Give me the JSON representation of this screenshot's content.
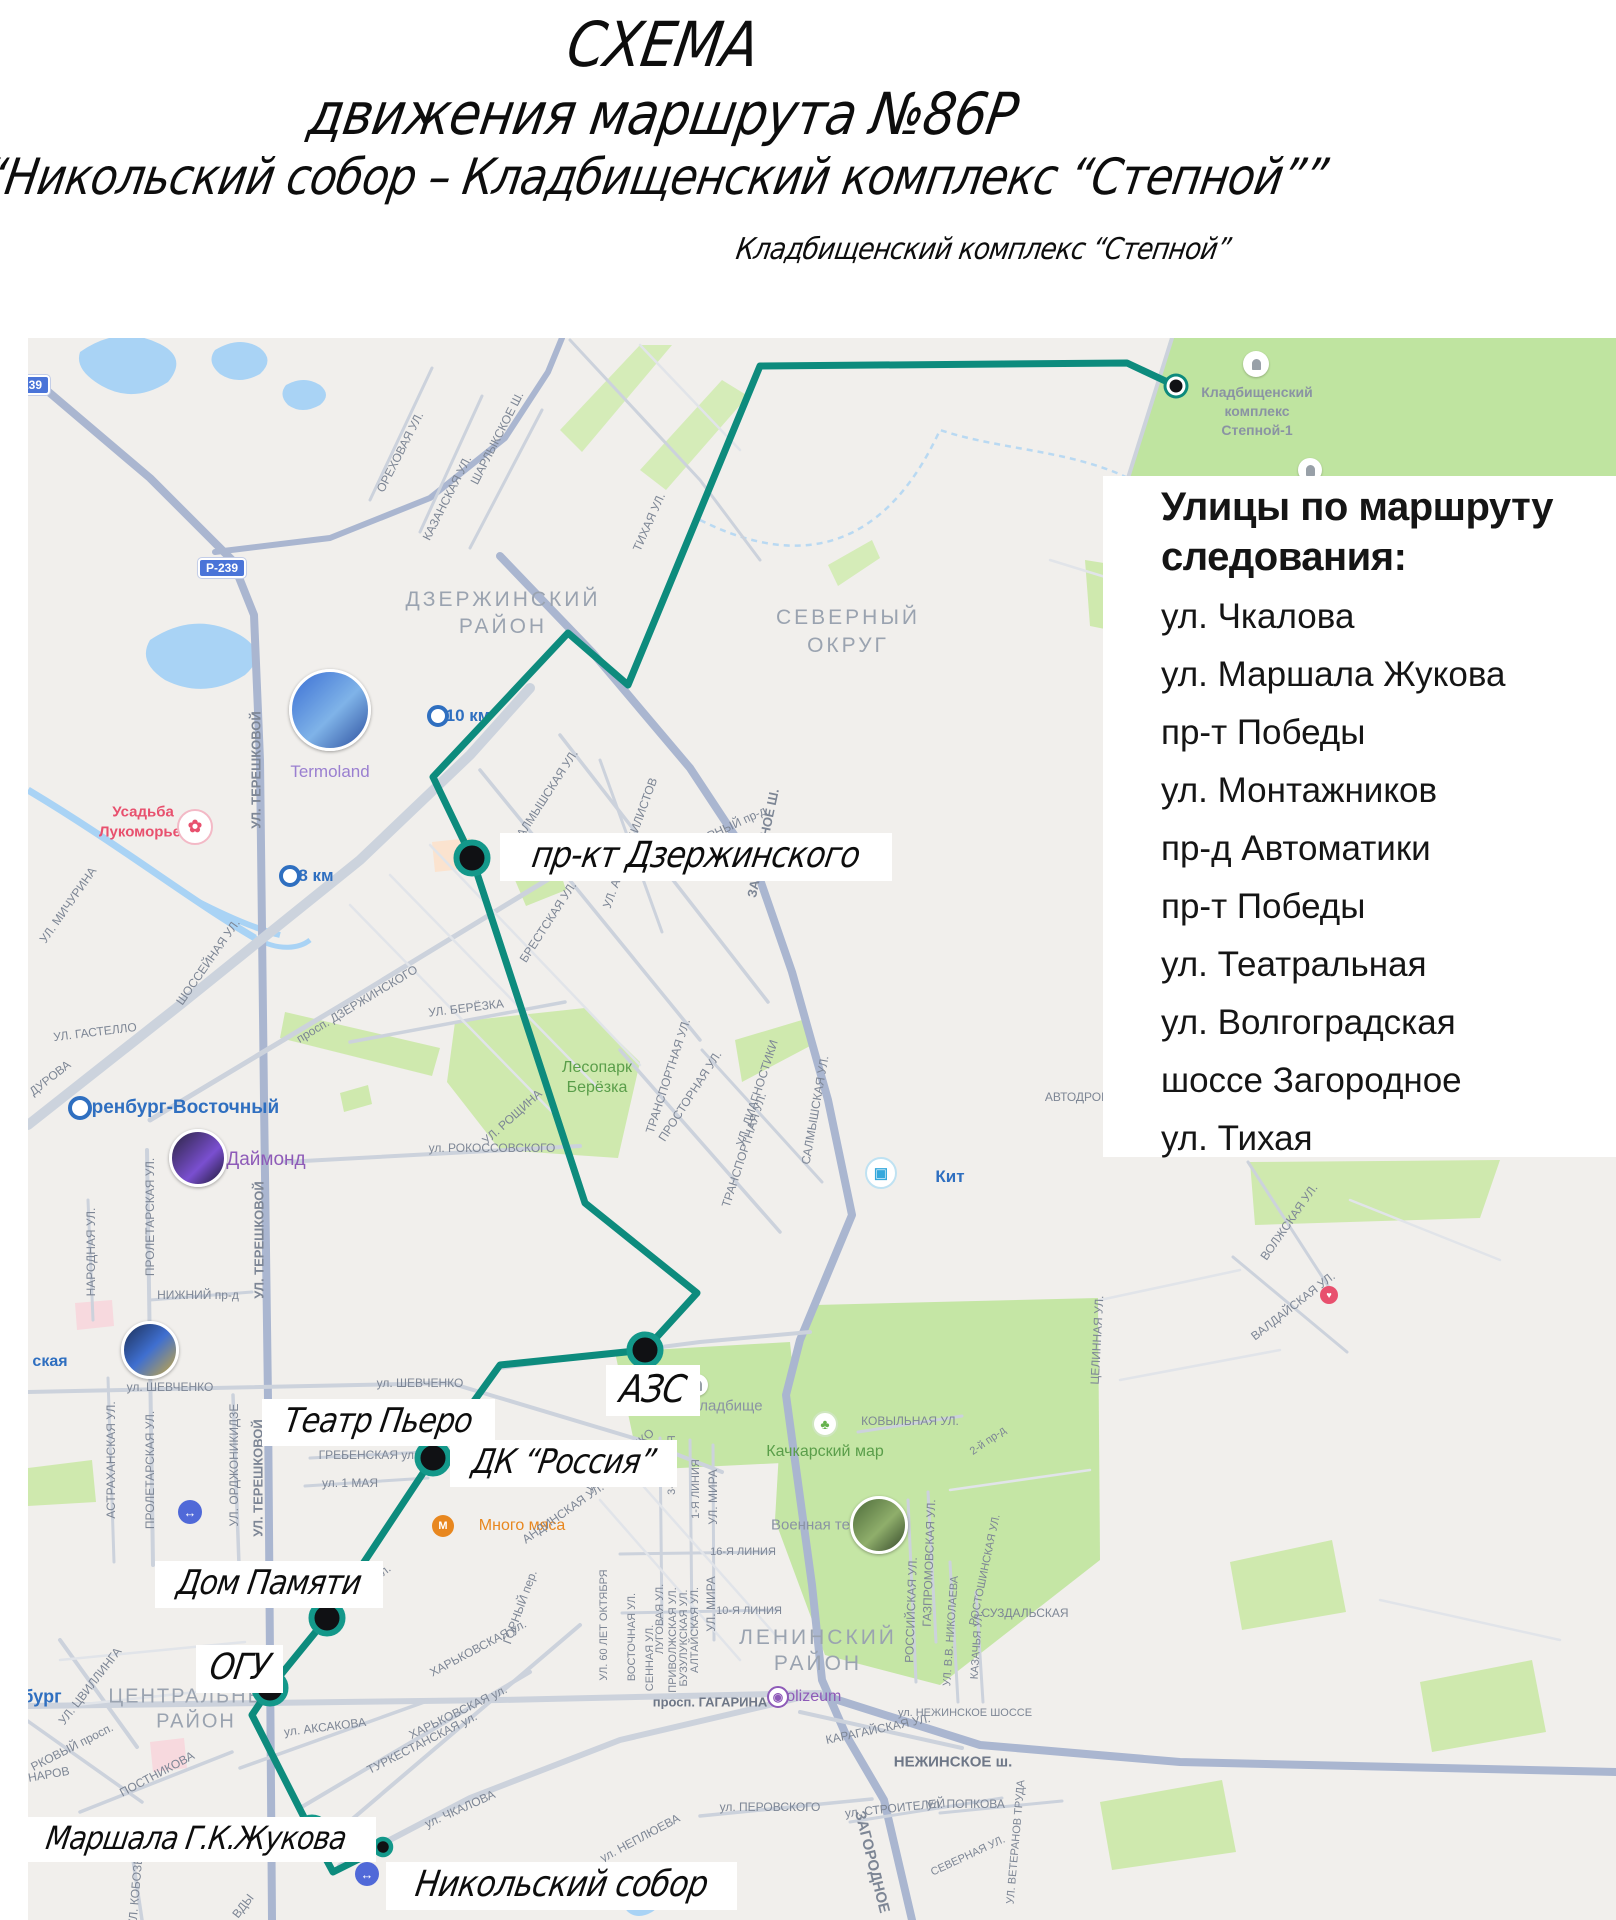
{
  "title": {
    "line1": "СХЕМА",
    "line2": "движения маршрута №86Р",
    "line3": "“Никольский собор – Кладбищенский комплекс “Степной””"
  },
  "endpoint_caption": "Кладбищенский комплекс “Степной”",
  "streets_panel": {
    "heading_line1": "Улицы по маршруту",
    "heading_line2": "следования:",
    "items": [
      "ул. Чкалова",
      "ул. Маршала Жукова",
      "пр-т Победы",
      "ул. Монтажников",
      "пр-д Автоматики",
      "пр-т Победы",
      "ул. Театральная",
      "ул. Волгоградская",
      "шоссе Загородное",
      "ул. Тихая"
    ]
  },
  "route": {
    "color": "#0d8b7d",
    "points": [
      [
        1176,
        386
      ],
      [
        1127,
        363
      ],
      [
        760,
        366
      ],
      [
        628,
        685
      ],
      [
        568,
        633
      ],
      [
        433,
        777
      ],
      [
        472,
        858
      ],
      [
        585,
        1203
      ],
      [
        697,
        1293
      ],
      [
        645,
        1350
      ],
      [
        500,
        1365
      ],
      [
        433,
        1458
      ],
      [
        327,
        1618
      ],
      [
        270,
        1688
      ],
      [
        252,
        1715
      ],
      [
        312,
        1833
      ],
      [
        333,
        1872
      ],
      [
        383,
        1847
      ]
    ]
  },
  "stops": [
    {
      "name": "stop-kladbishchensky-kompleks",
      "x": 1176,
      "y": 386,
      "type": "terminal"
    },
    {
      "name": "stop-prkt-dzerzhinskogo",
      "x": 472,
      "y": 858,
      "type": "big"
    },
    {
      "name": "stop-azs",
      "x": 645,
      "y": 1350,
      "type": "big"
    },
    {
      "name": "stop-dk-rossiya",
      "x": 433,
      "y": 1458,
      "type": "big"
    },
    {
      "name": "stop-dom-pamyati",
      "x": 327,
      "y": 1618,
      "type": "big"
    },
    {
      "name": "stop-ogu",
      "x": 270,
      "y": 1688,
      "type": "big"
    },
    {
      "name": "stop-marshala-zhukova",
      "x": 312,
      "y": 1833,
      "type": "big"
    },
    {
      "name": "stop-nikolsky-sobor",
      "x": 383,
      "y": 1847,
      "type": "small"
    }
  ],
  "hand_labels": [
    {
      "name": "stop-label-prkt-dzerzhinskogo",
      "text": "пр-кт Дзержинского",
      "x": 500,
      "y": 833,
      "fs": 36
    },
    {
      "name": "stop-label-azs",
      "text": "АЗС",
      "x": 606,
      "y": 1365,
      "fs": 38
    },
    {
      "name": "stop-label-teatr-piero",
      "text": "Театр Пьеро",
      "x": 262,
      "y": 1399,
      "fs": 34
    },
    {
      "name": "stop-label-dk-rossiya",
      "text": "ДК “Россия”",
      "x": 450,
      "y": 1440,
      "fs": 34
    },
    {
      "name": "stop-label-dom-pamyati",
      "text": "Дом Памяти",
      "x": 155,
      "y": 1561,
      "fs": 34
    },
    {
      "name": "stop-label-ogu",
      "text": "ОГУ",
      "x": 196,
      "y": 1645,
      "fs": 36
    },
    {
      "name": "stop-label-marshala-zhukova",
      "text": "Маршала Г.К.Жукова",
      "x": 16,
      "y": 1817,
      "fs": 32
    },
    {
      "name": "stop-label-nikolsky-sobor",
      "text": "Никольский собор",
      "x": 386,
      "y": 1862,
      "fs": 36
    }
  ],
  "cemetery_poi_label": {
    "lines": [
      "Кладбищенский",
      "комплекс",
      "Степной-1"
    ],
    "x": 1257,
    "y": 392,
    "line_h": 19
  },
  "km_markers": [
    {
      "name": "km-10-label",
      "text": "10 км",
      "x": 468,
      "y": 716
    },
    {
      "name": "km-8-label",
      "text": "8 км",
      "x": 316,
      "y": 876
    }
  ],
  "road_badges": [
    {
      "name": "road-badge-r239",
      "text": "Р-239",
      "x": 222,
      "y": 568
    },
    {
      "name": "road-badge-r239-edge",
      "text": "Р-239",
      "x": 26,
      "y": 385
    }
  ],
  "map_labels": [
    {
      "t": "ОРЕХОВАЯ УЛ.",
      "x": 400,
      "y": 452,
      "r": -63,
      "s": 12
    },
    {
      "t": "КАЗАНСКАЯ УЛ.",
      "x": 447,
      "y": 498,
      "r": -63,
      "s": 12
    },
    {
      "t": "ШАРЛЫКСКОЕ Ш.",
      "x": 497,
      "y": 438,
      "r": -63,
      "s": 12
    },
    {
      "t": "УЛ. ТЕРЕШКОВОЙ",
      "x": 256,
      "y": 770,
      "r": -90,
      "s": 13,
      "b": 1
    },
    {
      "t": "ДЗЕРЖИНСКИЙ",
      "x": 503,
      "y": 600,
      "s": 21,
      "c": "district",
      "ls": 3
    },
    {
      "t": "РАЙОН",
      "x": 503,
      "y": 627,
      "s": 21,
      "c": "district",
      "ls": 3
    },
    {
      "t": "СЕВЕРНЫЙ",
      "x": 848,
      "y": 618,
      "s": 21,
      "c": "district",
      "ls": 3
    },
    {
      "t": "ОКРУГ",
      "x": 848,
      "y": 646,
      "s": 21,
      "c": "district",
      "ls": 3
    },
    {
      "t": "ТИХАЯ УЛ.",
      "x": 649,
      "y": 522,
      "r": -66,
      "s": 12
    },
    {
      "t": "ПРОСТОРНАЯ УЛ.",
      "x": 690,
      "y": 1096,
      "r": -57,
      "s": 12
    },
    {
      "t": "САЛМЫШСКАЯ УЛ.",
      "x": 545,
      "y": 797,
      "r": -57,
      "s": 12
    },
    {
      "t": "БРЕСТСКАЯ УЛ.",
      "x": 548,
      "y": 922,
      "r": -57,
      "s": 12
    },
    {
      "t": "УЛ. АВТОМОБИЛИСТОВ",
      "x": 630,
      "y": 843,
      "r": -70,
      "s": 12
    },
    {
      "t": "СЕВЕРНЫЙ пр-д",
      "x": 722,
      "y": 830,
      "r": -25,
      "s": 12
    },
    {
      "t": "ЗАГОРОДНОЕ Ш.",
      "x": 763,
      "y": 843,
      "r": -78,
      "s": 13,
      "b": 1
    },
    {
      "t": "Termoland",
      "x": 330,
      "y": 772,
      "s": 17,
      "c": "purpleL"
    },
    {
      "t": "Усадьба",
      "x": 143,
      "y": 812,
      "s": 15,
      "c": "pink",
      "b": 1
    },
    {
      "t": "Лукоморье",
      "x": 140,
      "y": 832,
      "s": 15,
      "c": "pink",
      "b": 1
    },
    {
      "t": "УЛ. МИЧУРИНА",
      "x": 68,
      "y": 905,
      "r": -55,
      "s": 12
    },
    {
      "t": "ШОССЕЙНАЯ УЛ.",
      "x": 208,
      "y": 962,
      "r": -55,
      "s": 12
    },
    {
      "t": "УЛ. ГАСТЕЛЛО",
      "x": 95,
      "y": 1032,
      "r": -7,
      "s": 12
    },
    {
      "t": "ДУРОВА",
      "x": 50,
      "y": 1078,
      "r": -38,
      "s": 12
    },
    {
      "t": "Оренбург-Восточный",
      "x": 178,
      "y": 1108,
      "s": 19,
      "c": "blue",
      "b": 1
    },
    {
      "t": "Даймонд",
      "x": 266,
      "y": 1160,
      "s": 19,
      "c": "purple"
    },
    {
      "t": "просп. ДЗЕРЖИНСКОГО",
      "x": 357,
      "y": 1004,
      "r": -31,
      "s": 12
    },
    {
      "t": "УЛ. БЕРЁЗКА",
      "x": 466,
      "y": 1008,
      "r": -7,
      "s": 12
    },
    {
      "t": "УЛ. РОЩИНА",
      "x": 512,
      "y": 1117,
      "r": -42,
      "s": 12
    },
    {
      "t": "ул. РОКОССОВСКОГО",
      "x": 492,
      "y": 1148,
      "s": 12
    },
    {
      "t": "Лесопарк",
      "x": 597,
      "y": 1068,
      "s": 16,
      "c": "green"
    },
    {
      "t": "Берёзка",
      "x": 597,
      "y": 1088,
      "s": 16,
      "c": "green"
    },
    {
      "t": "ТРАНСПОРТНАЯ УЛ.",
      "x": 668,
      "y": 1076,
      "r": -72,
      "s": 12
    },
    {
      "t": "ТРАНСПОРТНАЯ УЛ.",
      "x": 744,
      "y": 1150,
      "r": -72,
      "s": 12
    },
    {
      "t": "УЛ. ДИАГНОСТИКИ",
      "x": 757,
      "y": 1093,
      "r": -72,
      "s": 12
    },
    {
      "t": "САЛМЫШСКАЯ УЛ.",
      "x": 815,
      "y": 1110,
      "r": -80,
      "s": 12
    },
    {
      "t": "Кит",
      "x": 950,
      "y": 1177,
      "s": 17,
      "c": "blue",
      "b": 1
    },
    {
      "t": "АВТОДРОМ",
      "x": 1078,
      "y": 1097,
      "s": 12
    },
    {
      "t": "КОВЫЛЬНАЯ УЛ.",
      "x": 910,
      "y": 1421,
      "s": 12
    },
    {
      "t": "2-й пр-д",
      "x": 988,
      "y": 1441,
      "r": -35,
      "s": 11
    },
    {
      "t": "Качкарский мар",
      "x": 825,
      "y": 1452,
      "s": 16,
      "c": "green"
    },
    {
      "t": "Военная техника",
      "x": 830,
      "y": 1525,
      "s": 15,
      "c": "gray"
    },
    {
      "t": "Старое кладбище",
      "x": 700,
      "y": 1406,
      "s": 15,
      "c": "gray"
    },
    {
      "t": "ЦЕЛИННАЯ УЛ.",
      "x": 1097,
      "y": 1340,
      "r": -87,
      "s": 12
    },
    {
      "t": "ВОЛЖСКАЯ УЛ.",
      "x": 1289,
      "y": 1222,
      "r": -55,
      "s": 12
    },
    {
      "t": "ВАЛДАЙСКАЯ УЛ.",
      "x": 1293,
      "y": 1306,
      "r": -38,
      "s": 12
    },
    {
      "t": "ЛЕНИНСКИЙ",
      "x": 818,
      "y": 1638,
      "s": 21,
      "c": "district",
      "ls": 3
    },
    {
      "t": "РАЙОН",
      "x": 818,
      "y": 1664,
      "s": 21,
      "c": "district",
      "ls": 3
    },
    {
      "t": "РОССИЙСКАЯ УЛ.",
      "x": 911,
      "y": 1610,
      "r": -88,
      "s": 12
    },
    {
      "t": "ГАЗПРОМОВСКАЯ УЛ.",
      "x": 929,
      "y": 1563,
      "r": -88,
      "s": 12
    },
    {
      "t": "УЛ. В.В. НИКОЛАЕВА",
      "x": 951,
      "y": 1631,
      "r": -86,
      "s": 11
    },
    {
      "t": "КАЗАЧЬЯ УЛ.",
      "x": 977,
      "y": 1645,
      "r": -86,
      "s": 11
    },
    {
      "t": "РОСТОШИНСКАЯ УЛ.",
      "x": 985,
      "y": 1570,
      "r": -78,
      "s": 11
    },
    {
      "t": "СУЗДАЛЬСКАЯ",
      "x": 1025,
      "y": 1613,
      "s": 12
    },
    {
      "t": "УЛ. МИРА",
      "x": 713,
      "y": 1497,
      "r": -90,
      "s": 12
    },
    {
      "t": "УЛ. МИРА",
      "x": 711,
      "y": 1604,
      "r": -90,
      "s": 12
    },
    {
      "t": "3-Я ЛИНИЯ",
      "x": 672,
      "y": 1465,
      "r": -90,
      "s": 11
    },
    {
      "t": "1-Я ЛИНИЯ",
      "x": 696,
      "y": 1489,
      "r": -90,
      "s": 11
    },
    {
      "t": "16-Я ЛИНИЯ",
      "x": 743,
      "y": 1552,
      "s": 11
    },
    {
      "t": "10-Я ЛИНИЯ",
      "x": 749,
      "y": 1611,
      "s": 11
    },
    {
      "t": "УЛ. 60 ЛЕТ ОКТЯБРЯ",
      "x": 604,
      "y": 1625,
      "r": -90,
      "s": 11
    },
    {
      "t": "ВОСТОЧНАЯ УЛ.",
      "x": 632,
      "y": 1637,
      "r": -90,
      "s": 11
    },
    {
      "t": "СЕННАЯ УЛ.",
      "x": 650,
      "y": 1658,
      "r": -90,
      "s": 11
    },
    {
      "t": "ЛУГОВАЯ УЛ.",
      "x": 660,
      "y": 1619,
      "r": -90,
      "s": 11
    },
    {
      "t": "ПРИВОЛЖСКАЯ УЛ.",
      "x": 673,
      "y": 1640,
      "r": -90,
      "s": 11
    },
    {
      "t": "БУЗУЛУКСКАЯ УЛ.",
      "x": 684,
      "y": 1638,
      "r": -90,
      "s": 11
    },
    {
      "t": "АЛТАЙСКАЯ УЛ.",
      "x": 695,
      "y": 1630,
      "r": -90,
      "s": 11
    },
    {
      "t": "просп. ГАГАРИНА",
      "x": 710,
      "y": 1702,
      "s": 13,
      "b": 1,
      "c": "streetDark"
    },
    {
      "t": "Colizeum",
      "x": 808,
      "y": 1697,
      "s": 16,
      "c": "purple"
    },
    {
      "t": "КАРАГАЙСКАЯ УЛ.",
      "x": 878,
      "y": 1729,
      "r": -12,
      "s": 12
    },
    {
      "t": "ул. НЕЖИНСКОЕ ШОССЕ",
      "x": 965,
      "y": 1713,
      "s": 11
    },
    {
      "t": "НЕЖИНСКОЕ ш.",
      "x": 953,
      "y": 1762,
      "s": 15,
      "b": 1,
      "c": "streetDark"
    },
    {
      "t": "ул. ПЕРОВСКОГО",
      "x": 770,
      "y": 1807,
      "s": 12
    },
    {
      "t": "ул. СТРОИТЕЛЕЙ",
      "x": 895,
      "y": 1808,
      "r": -6,
      "s": 12
    },
    {
      "t": "ул. ПОПКОВА",
      "x": 966,
      "y": 1804,
      "s": 12
    },
    {
      "t": "ул. НЕПЛЮЕВА",
      "x": 640,
      "y": 1838,
      "r": -28,
      "s": 12
    },
    {
      "t": "ЗАГОРОДНОЕ",
      "x": 872,
      "y": 1862,
      "r": 76,
      "s": 15,
      "b": 1
    },
    {
      "t": "СЕВЕРНАЯ УЛ.",
      "x": 968,
      "y": 1856,
      "r": -25,
      "s": 11
    },
    {
      "t": "УЛ. ВЕТЕРАНОВ ТРУДА",
      "x": 1016,
      "y": 1842,
      "r": -85,
      "s": 11
    },
    {
      "t": "ул. ШЕВЧЕНКО",
      "x": 170,
      "y": 1387,
      "s": 12
    },
    {
      "t": "ул. ШЕВЧЕНКО",
      "x": 420,
      "y": 1383,
      "s": 12
    },
    {
      "t": "ул. ШЕВЧЕНКО",
      "x": 620,
      "y": 1460,
      "r": -42,
      "s": 12
    },
    {
      "t": "ГРЕБЕНСКАЯ ул.",
      "x": 368,
      "y": 1455,
      "s": 12
    },
    {
      "t": "ул. 1 МАЯ",
      "x": 350,
      "y": 1483,
      "s": 12
    },
    {
      "t": "Много мяса",
      "x": 522,
      "y": 1526,
      "s": 16,
      "c": "orange"
    },
    {
      "t": "ОРСКАЯ ул.",
      "x": 362,
      "y": 1588,
      "r": -38,
      "s": 12
    },
    {
      "t": "ГОРНЫЙ пер.",
      "x": 520,
      "y": 1607,
      "r": -70,
      "s": 12
    },
    {
      "t": "АНДИНСКАЯ УЛ.",
      "x": 563,
      "y": 1513,
      "r": -35,
      "s": 12
    },
    {
      "t": "ХАРЬКОВСКАЯ ул.",
      "x": 478,
      "y": 1648,
      "r": -28,
      "s": 12
    },
    {
      "t": "ХАРЬКОВСКАЯ ул.",
      "x": 458,
      "y": 1712,
      "r": -26,
      "s": 12
    },
    {
      "t": "ТУРКЕСТАНСКАЯ ул.",
      "x": 422,
      "y": 1743,
      "r": -27,
      "s": 12
    },
    {
      "t": "ул. АКСАКОВА",
      "x": 325,
      "y": 1727,
      "r": -7,
      "s": 12
    },
    {
      "t": "ул. ЧКАЛОВА",
      "x": 460,
      "y": 1809,
      "r": -24,
      "s": 12
    },
    {
      "t": "ЦЕНТРАЛЬНЫЙ",
      "x": 196,
      "y": 1697,
      "s": 20,
      "c": "district",
      "ls": 2
    },
    {
      "t": "РАЙОН",
      "x": 196,
      "y": 1722,
      "s": 20,
      "c": "district",
      "ls": 2
    },
    {
      "t": "бург",
      "x": 42,
      "y": 1697,
      "s": 18,
      "c": "blue",
      "b": 1
    },
    {
      "t": "УЛ. ЦВИЛЛИНГА",
      "x": 90,
      "y": 1686,
      "r": -52,
      "s": 12
    },
    {
      "t": "РКОВЫЙ просп.",
      "x": 72,
      "y": 1747,
      "r": -27,
      "s": 12
    },
    {
      "t": "УНАРОВ",
      "x": 45,
      "y": 1775,
      "r": -10,
      "s": 12
    },
    {
      "t": "ПОСТНИКОВА",
      "x": 157,
      "y": 1774,
      "r": -28,
      "s": 12
    },
    {
      "t": "УЛ. КОБОЗЕВА",
      "x": 136,
      "y": 1884,
      "r": -85,
      "s": 12
    },
    {
      "t": "ВДЫ",
      "x": 243,
      "y": 1906,
      "r": -52,
      "s": 12
    },
    {
      "t": "НИЖНИЙ пр-д",
      "x": 198,
      "y": 1295,
      "s": 12
    },
    {
      "t": "НАРОДНАЯ УЛ.",
      "x": 91,
      "y": 1252,
      "r": -90,
      "s": 12
    },
    {
      "t": "ПРОЛЕТАРСКАЯ УЛ.",
      "x": 150,
      "y": 1217,
      "r": -90,
      "s": 12
    },
    {
      "t": "ПРОЛЕТАРСКАЯ УЛ.",
      "x": 150,
      "y": 1470,
      "r": -90,
      "s": 12
    },
    {
      "t": "АСТРАХАНСКАЯ УЛ.",
      "x": 111,
      "y": 1460,
      "r": -90,
      "s": 12
    },
    {
      "t": "УЛ. ОРДЖОНИКИДЗЕ",
      "x": 234,
      "y": 1465,
      "r": -90,
      "s": 12
    },
    {
      "t": "УЛ. ТЕРЕШКОВОЙ",
      "x": 259,
      "y": 1240,
      "r": -90,
      "s": 13,
      "b": 1
    },
    {
      "t": "УЛ. ТЕРЕШКОВОЙ",
      "x": 258,
      "y": 1478,
      "r": -90,
      "s": 13,
      "b": 1
    },
    {
      "t": "ская",
      "x": 50,
      "y": 1362,
      "s": 16,
      "c": "blue",
      "b": 1
    }
  ],
  "pois": [
    {
      "n": "termoland-photo-icon",
      "t": "photo",
      "x": 330,
      "y": 710,
      "r": 38,
      "g": "linear-gradient(135deg,#3b6fd4,#7fb3e8 55%,#2c4f9e)"
    },
    {
      "n": "diamond-photo-icon",
      "t": "photo",
      "x": 198,
      "y": 1158,
      "r": 26,
      "g": "linear-gradient(135deg,#2a2440,#7a4fd0 60%,#1b1830)"
    },
    {
      "n": "colizeum-photo-icon",
      "t": "photo",
      "x": 150,
      "y": 1350,
      "r": 26,
      "g": "linear-gradient(135deg,#1c2f55,#3f6fd0 50%,#caa93e)"
    },
    {
      "n": "military-photo-icon",
      "t": "photo",
      "x": 879,
      "y": 1525,
      "r": 26,
      "g": "linear-gradient(135deg,#4d6b3a,#8fae6b 55%,#35492a)"
    },
    {
      "n": "lukomorye-icon",
      "t": "badge",
      "x": 195,
      "y": 827,
      "r": 16,
      "bg": "#fff",
      "glyph": "✿",
      "gc": "#e8506e",
      "gs": 17,
      "border": "#f3b9c6"
    },
    {
      "n": "kit-icon",
      "t": "badge",
      "x": 881,
      "y": 1173,
      "r": 14,
      "bg": "#fff",
      "glyph": "▣",
      "gc": "#35a8dc",
      "gs": 15,
      "border": "#bfe2f2"
    },
    {
      "n": "gazovik-metro-icon",
      "t": "badge",
      "x": 367,
      "y": 1874,
      "r": 12,
      "bg": "#5069d8",
      "glyph": "↔",
      "gc": "#fff",
      "gs": 13
    },
    {
      "n": "metro-icon",
      "t": "badge",
      "x": 190,
      "y": 1512,
      "r": 12,
      "bg": "#5069d8",
      "glyph": "↔",
      "gc": "#fff",
      "gs": 13
    },
    {
      "n": "colizeum-mini-icon",
      "t": "badge",
      "x": 778,
      "y": 1697,
      "r": 9,
      "bg": "#fff",
      "glyph": "◉",
      "gc": "#8e5bb8",
      "gs": 12,
      "border": "#8e5bb8"
    },
    {
      "n": "kachkarsky-tree-icon",
      "t": "badge",
      "x": 825,
      "y": 1424,
      "r": 11,
      "bg": "#fff",
      "glyph": "♣",
      "gc": "#66b24e",
      "gs": 14,
      "border": "#cfe6bf"
    },
    {
      "n": "mnogo-myasa-icon",
      "t": "badge",
      "x": 443,
      "y": 1526,
      "r": 11,
      "bg": "#e8871f",
      "glyph": "М",
      "gc": "#fff",
      "gs": 11
    },
    {
      "n": "pink-marker-icon",
      "t": "badge",
      "x": 1329,
      "y": 1295,
      "r": 9,
      "bg": "#e8506e",
      "glyph": "♥",
      "gc": "#fff",
      "gs": 9
    },
    {
      "n": "cemetery-icon",
      "t": "tomb",
      "x": 1256,
      "y": 364,
      "r": 13
    },
    {
      "n": "cemetery-icon-2",
      "t": "tomb",
      "x": 1310,
      "y": 470,
      "r": 12
    },
    {
      "n": "old-cemetery-icon",
      "t": "tomb",
      "x": 697,
      "y": 1385,
      "r": 11
    },
    {
      "n": "orenburg-vostochny-dot",
      "t": "ring",
      "x": 80,
      "y": 1108,
      "r": 8,
      "border": "#2f6fc0"
    },
    {
      "n": "km10-ring",
      "t": "ring",
      "x": 438,
      "y": 716,
      "r": 7,
      "border": "#2f6fc0"
    },
    {
      "n": "km8-ring",
      "t": "ring",
      "x": 290,
      "y": 876,
      "r": 7,
      "border": "#2f6fc0"
    }
  ],
  "colors": {
    "street": "#7d8695",
    "streetDark": "#6e7787",
    "district": "#9aa3b0",
    "blue": "#2f6fc0",
    "purple": "#8e5bb8",
    "purpleL": "#9a7fd0",
    "pink": "#e8506e",
    "orange": "#e8871f",
    "green": "#5a9e4a",
    "gray": "#8a93a3",
    "route": "#0d8b7d"
  }
}
